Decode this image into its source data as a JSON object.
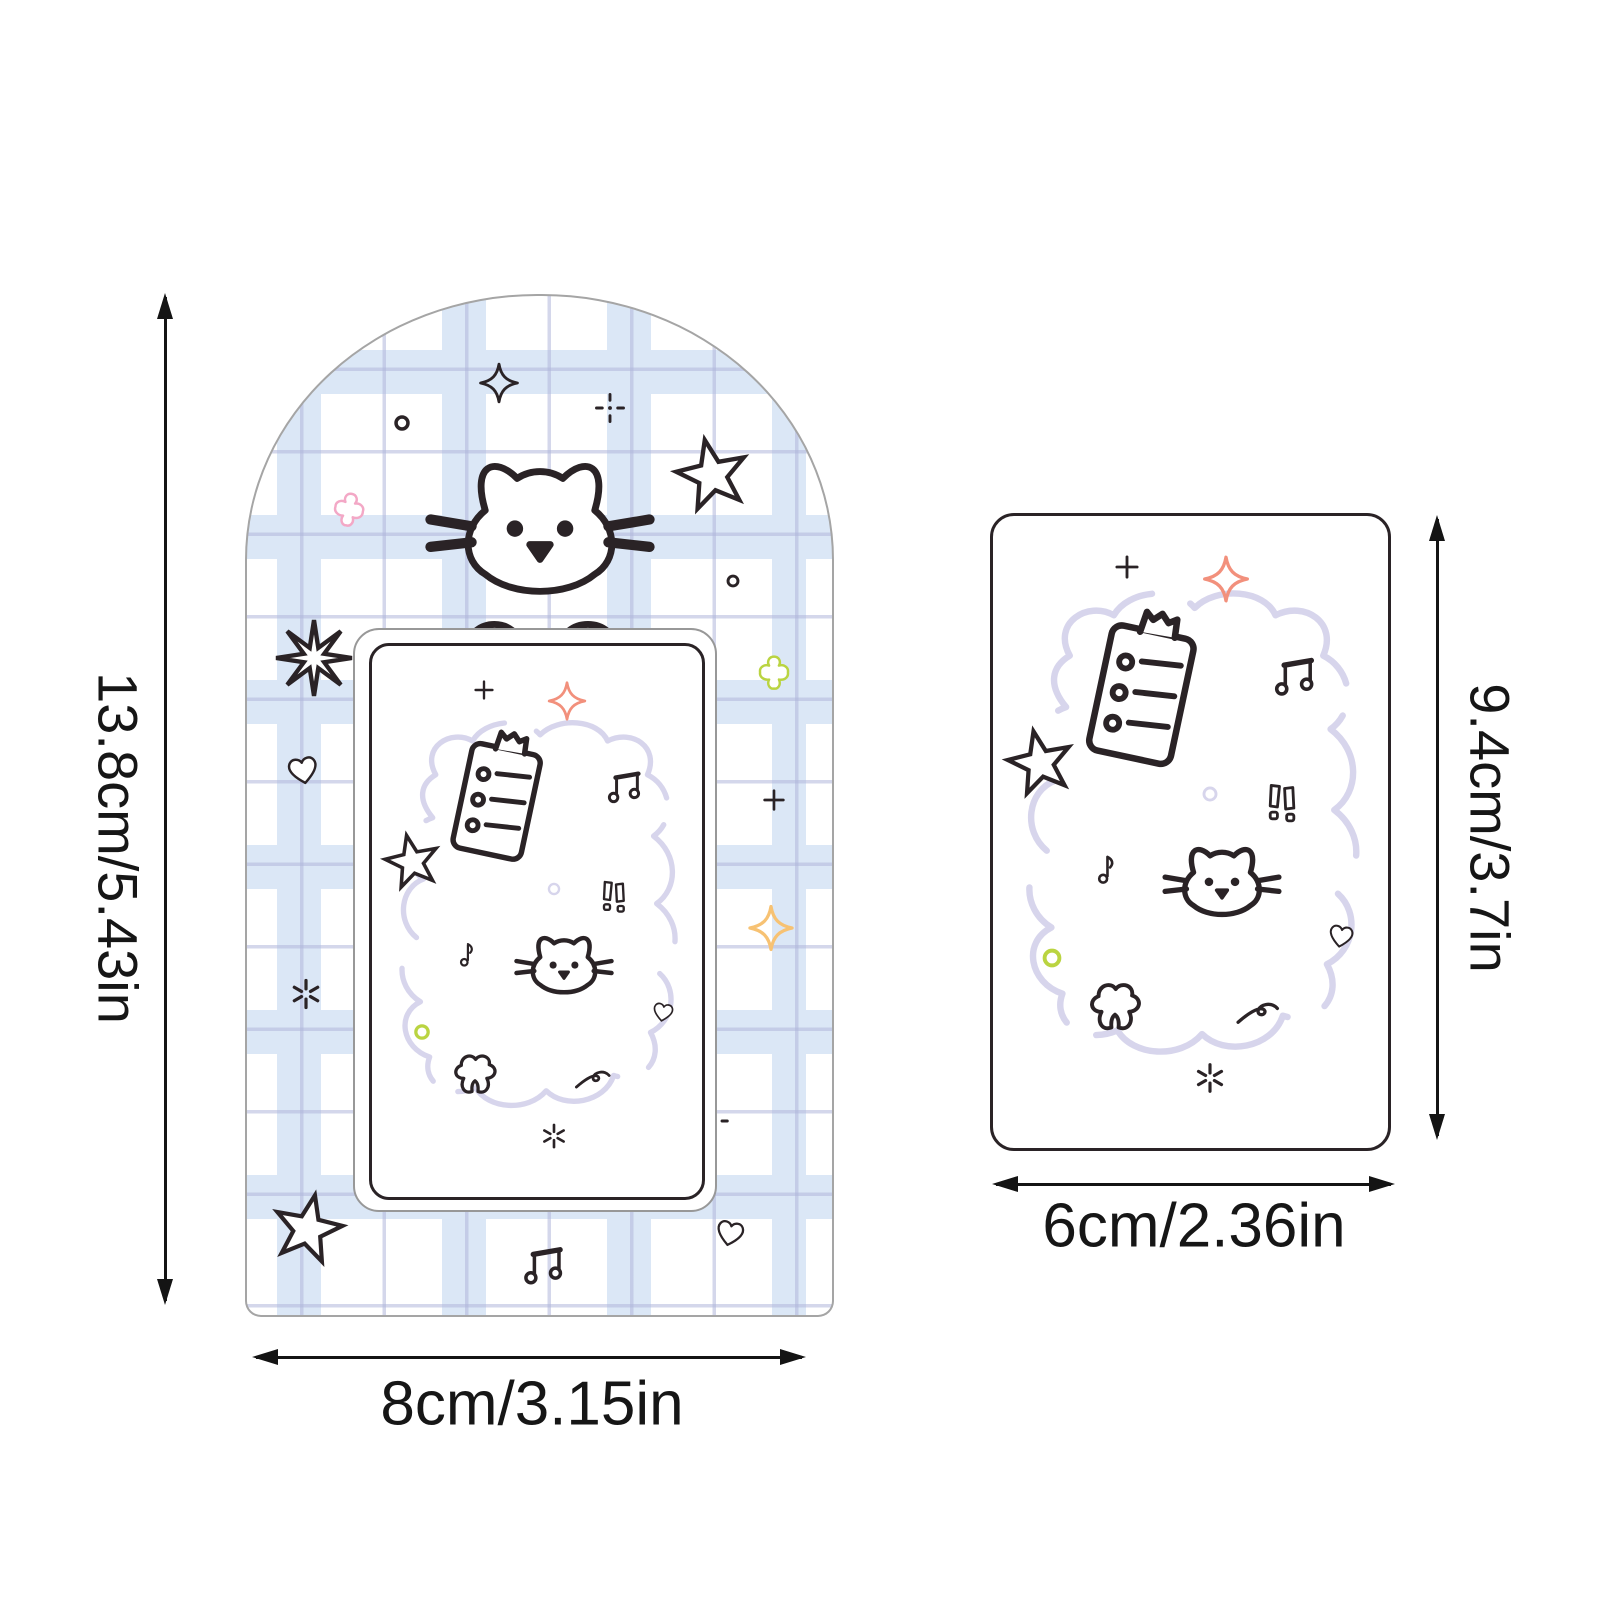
{
  "product": {
    "holder": {
      "name": "arched-photocard-holder",
      "height_label": "13.8cm/5.43in",
      "width_label": "8cm/3.15in"
    },
    "card": {
      "name": "photocard",
      "height_label": "9.4cm/3.7in",
      "width_label": "6cm/2.36in"
    }
  },
  "colors": {
    "ink": "#2a2326",
    "dim_line": "#141414",
    "lavender": "#cfcde8",
    "pale_lavender": "#d7d5ec",
    "pink": "#f3a8c6",
    "green": "#bad441",
    "coral": "#f2907c",
    "orange": "#f7c273",
    "plaid_band": "#dbe7f6",
    "plaid_line": "#b0b6db",
    "frame_gray": "#a5a5a5"
  },
  "holder_doodles": [
    {
      "icon": "sparkle4",
      "name": "sparkle-icon",
      "x": 43,
      "y": 8.5,
      "w": 7,
      "sw": 7
    },
    {
      "icon": "dotplus",
      "name": "plus-sparkle-icon",
      "x": 62,
      "y": 11,
      "w": 5.5,
      "sw": 9
    },
    {
      "icon": "circle-o",
      "name": "dot-icon",
      "x": 26.5,
      "y": 12.5,
      "w": 3,
      "sw": 20
    },
    {
      "icon": "star5",
      "name": "star-icon",
      "x": 79.5,
      "y": 17.5,
      "w": 13.5,
      "rot": -12,
      "sw": 5.5
    },
    {
      "icon": "clover4",
      "name": "clover-icon",
      "x": 17.5,
      "y": 21,
      "w": 7,
      "rot": 10,
      "color": "pink"
    },
    {
      "icon": "cat-peek",
      "name": "peeking-cat-icon",
      "x": 50,
      "y": 25.5,
      "w": 39,
      "sw": 3
    },
    {
      "icon": "circle-o",
      "name": "dot-icon",
      "x": 83,
      "y": 28,
      "w": 2.5,
      "sw": 20
    },
    {
      "icon": "burst8",
      "name": "burst-star-icon",
      "x": 11.5,
      "y": 35.5,
      "w": 13.5,
      "sw": 5.5
    },
    {
      "icon": "clover4",
      "name": "clover-icon",
      "x": 90,
      "y": 37,
      "w": 7,
      "color": "green"
    },
    {
      "icon": "heart",
      "name": "heart-icon",
      "x": 9.5,
      "y": 46.5,
      "w": 7,
      "rot": -10
    },
    {
      "icon": "plus",
      "name": "plus-icon",
      "x": 90,
      "y": 49.5,
      "w": 5,
      "sw": 9
    },
    {
      "icon": "sparkle4",
      "name": "sparkle-icon",
      "x": 89.5,
      "y": 62,
      "w": 8,
      "color": "orange",
      "sw": 7
    },
    {
      "icon": "asterisk6",
      "name": "sparkle-dots-icon",
      "x": 10,
      "y": 68.5,
      "w": 5.5,
      "sw": 10
    },
    {
      "icon": "dotplus",
      "name": "plus-sparkle-icon",
      "x": 80,
      "y": 81,
      "w": 5,
      "sw": 10
    },
    {
      "icon": "star5",
      "name": "star-icon",
      "x": 10.5,
      "y": 91.5,
      "w": 13,
      "rot": 12,
      "sw": 5.5
    },
    {
      "icon": "heart",
      "name": "heart-icon",
      "x": 82.5,
      "y": 92,
      "w": 6.5,
      "rot": 12
    },
    {
      "icon": "note2",
      "name": "music-notes-icon",
      "x": 50.5,
      "y": 95.5,
      "w": 10
    }
  ],
  "card_doodles": [
    {
      "icon": "cloud",
      "name": "cloud-outline",
      "x": 50,
      "y": 50,
      "w": 93,
      "color": "pale_lavender",
      "sw": 3.5
    },
    {
      "icon": "plus",
      "name": "plus-icon",
      "x": 34,
      "y": 8,
      "w": 8,
      "sw": 9
    },
    {
      "icon": "sparkle4",
      "name": "sparkle-icon",
      "x": 59,
      "y": 10,
      "w": 12,
      "color": "coral",
      "sw": 7
    },
    {
      "icon": "clipboard",
      "name": "memo-pad-icon",
      "x": 38,
      "y": 27,
      "w": 33,
      "rot": 12,
      "sw": 5
    },
    {
      "icon": "note2",
      "name": "music-notes-icon",
      "x": 76,
      "y": 26,
      "w": 15
    },
    {
      "icon": "star5",
      "name": "star-icon",
      "x": 12,
      "y": 39,
      "w": 18,
      "rot": -12
    },
    {
      "icon": "circle-o",
      "name": "dot-icon",
      "x": 55,
      "y": 44,
      "w": 4.5,
      "color": "pale_lavender",
      "sw": 16
    },
    {
      "icon": "excl2",
      "name": "exclamation-icon",
      "x": 73,
      "y": 46,
      "w": 13,
      "sw": 5.5
    },
    {
      "icon": "note1",
      "name": "music-note-icon",
      "x": 28,
      "y": 56,
      "w": 11
    },
    {
      "icon": "cat-face",
      "name": "cat-icon",
      "x": 58,
      "y": 59,
      "w": 30,
      "sw": 4.5
    },
    {
      "icon": "heart",
      "name": "heart-icon",
      "x": 88,
      "y": 66.5,
      "w": 8.5,
      "rot": 10
    },
    {
      "icon": "circle-o",
      "name": "dot-icon",
      "x": 15,
      "y": 70,
      "w": 5.5,
      "color": "green",
      "sw": 18
    },
    {
      "icon": "flower",
      "name": "flower-icon",
      "x": 31,
      "y": 78,
      "w": 18,
      "sw": 5.5
    },
    {
      "icon": "squiggle",
      "name": "squiggle-icon",
      "x": 67,
      "y": 78,
      "w": 14
    },
    {
      "icon": "asterisk6",
      "name": "sparkle-dots-icon",
      "x": 55,
      "y": 89,
      "w": 8,
      "sw": 10
    }
  ]
}
